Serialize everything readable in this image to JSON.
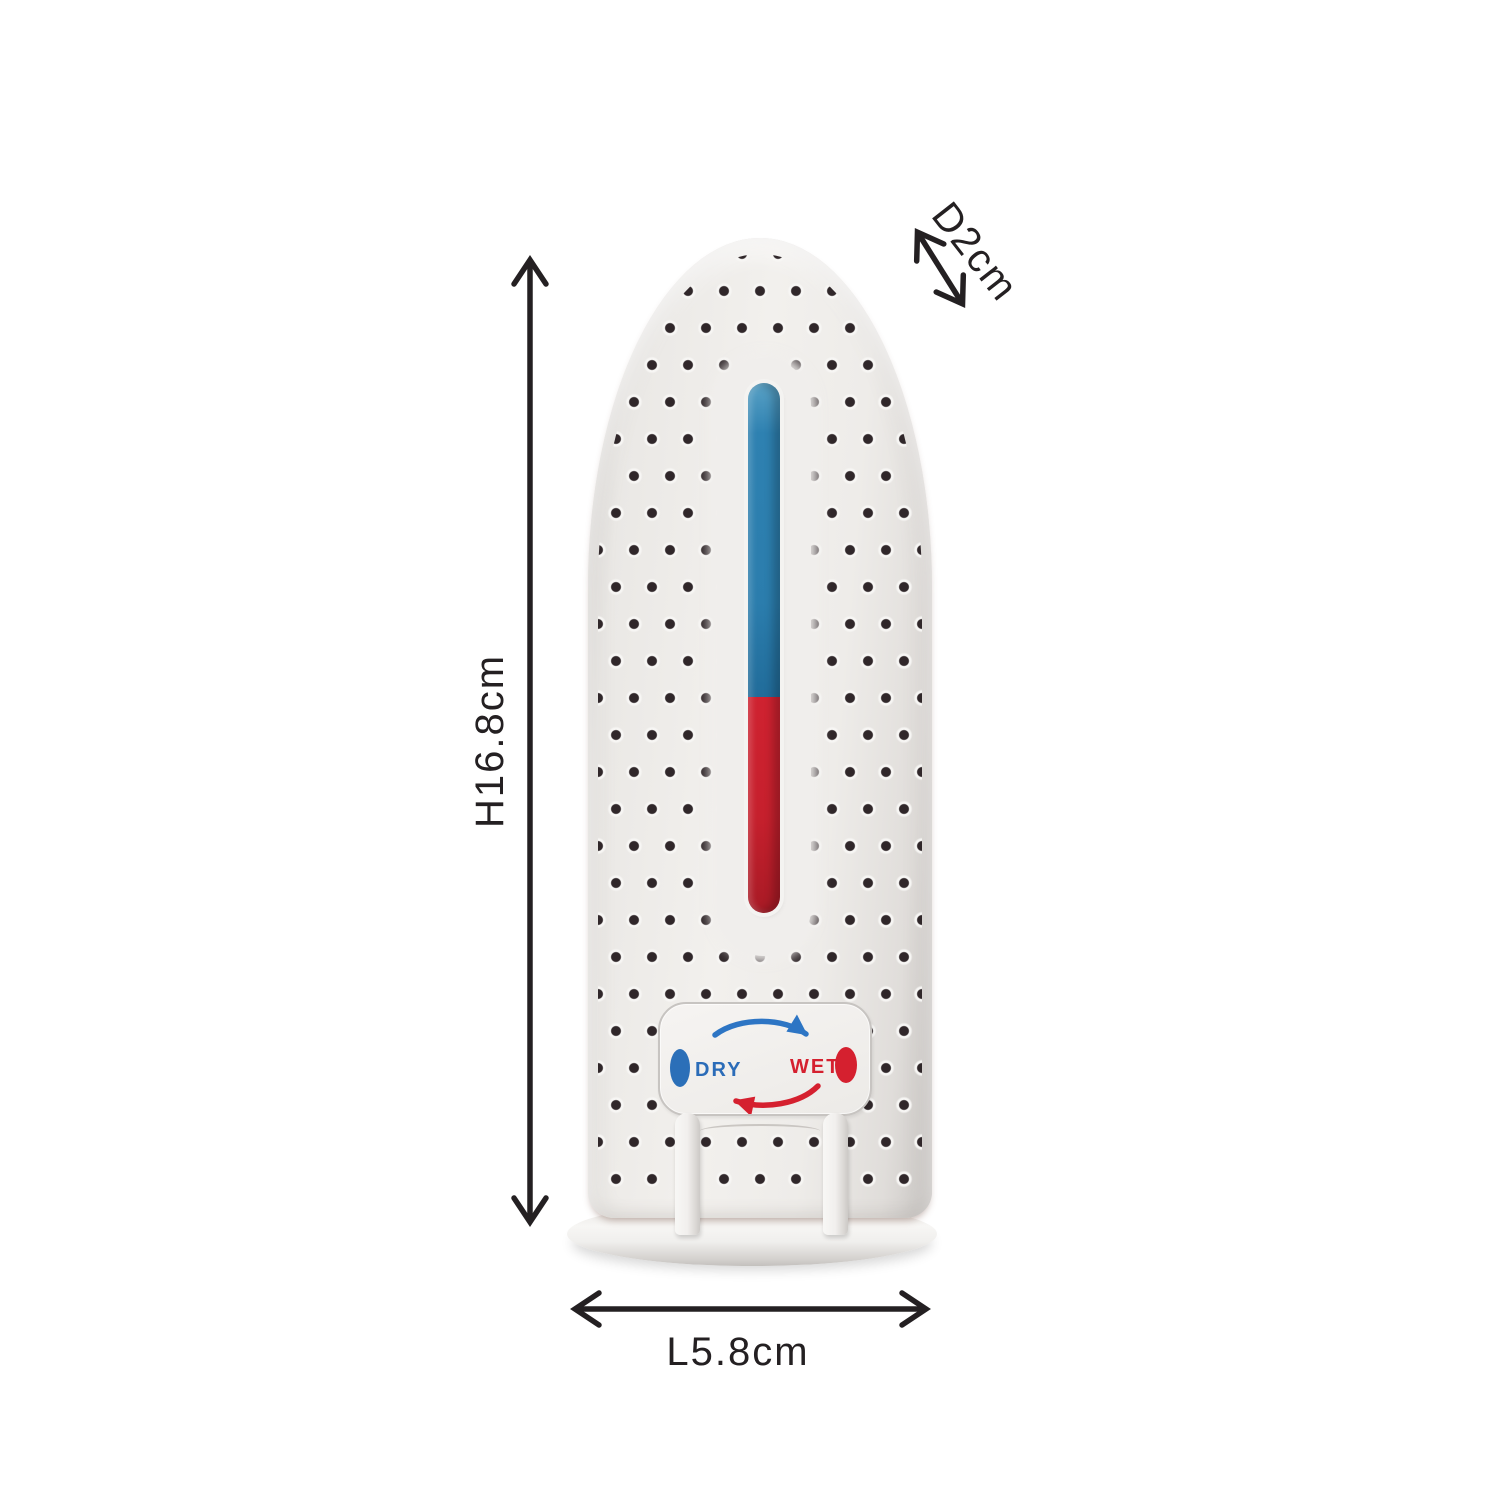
{
  "dimensions": {
    "annotation_color": "#242022",
    "height": {
      "label": "H16.8cm"
    },
    "depth": {
      "label": "D2cm"
    },
    "length": {
      "label": "L5.8cm"
    }
  },
  "device": {
    "body_color": "#efedea",
    "hole_color": "#30272a",
    "indicator": {
      "dry_color": "#2b7dad",
      "wet_color": "#c6202d"
    },
    "panel": {
      "dry_label": "DRY",
      "dry_color": "#2b6cb8",
      "wet_label": "WET",
      "wet_color": "#d5202f"
    }
  }
}
